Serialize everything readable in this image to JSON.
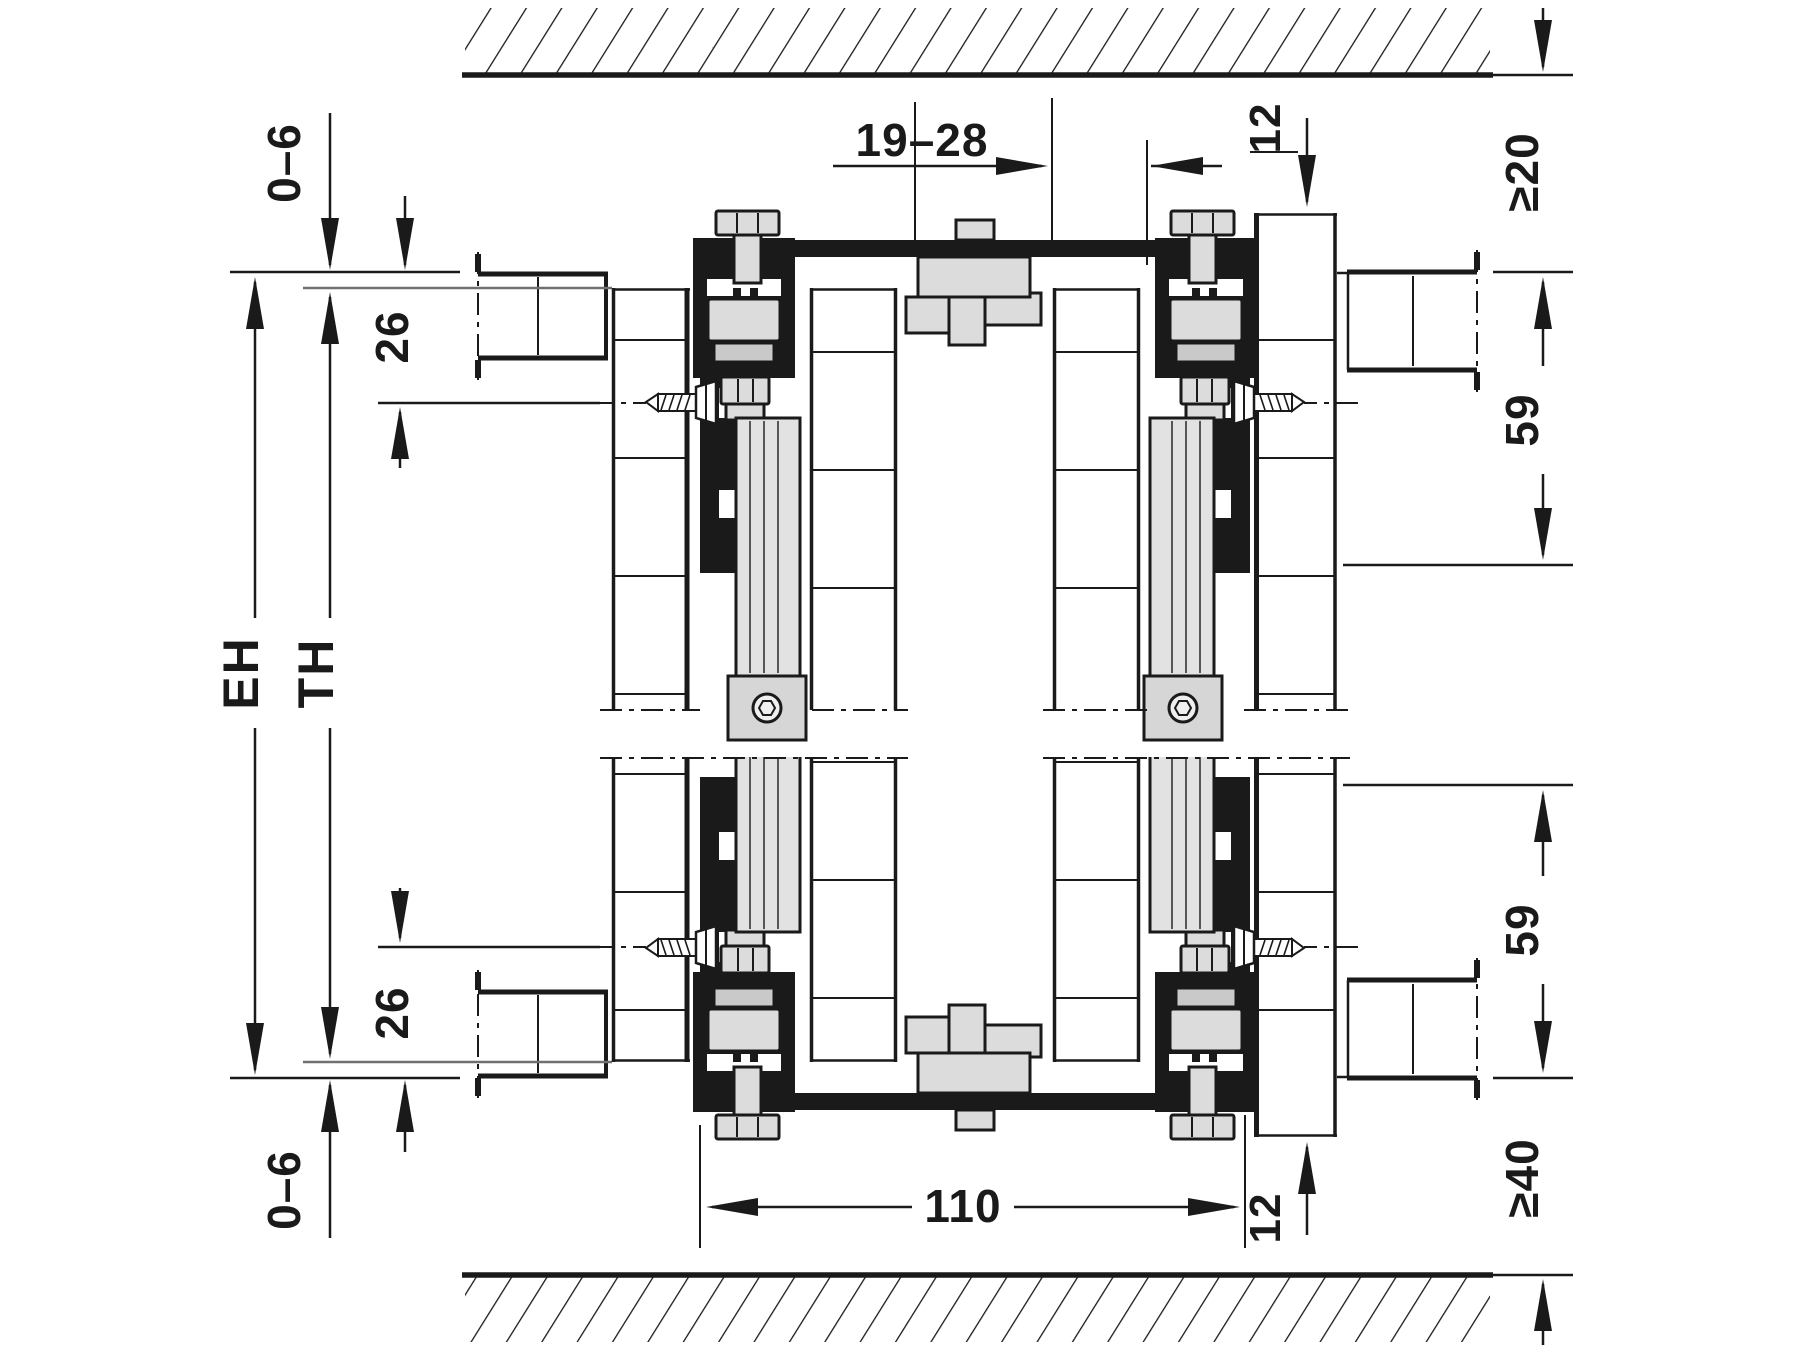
{
  "drawing": {
    "type": "technical-section",
    "labels": {
      "top_adjustment": "0–6",
      "top_offset": "26",
      "installation_height": "EH",
      "door_height": "TH",
      "door_thickness_range": "19–28",
      "top_engagement": "12",
      "top_clearance": "≥20",
      "upper_track_zone": "59",
      "lower_track_zone": "59",
      "bottom_clearance": "≥40",
      "track_width": "110",
      "bottom_engagement": "12",
      "bottom_offset": "26",
      "bottom_adjustment": "0–6"
    },
    "colors": {
      "ink": "#1a1a1a",
      "metal_light": "#dcdcdc",
      "metal_mid": "#c9c9c9",
      "reference_line": "#707070",
      "background": "#ffffff"
    }
  }
}
